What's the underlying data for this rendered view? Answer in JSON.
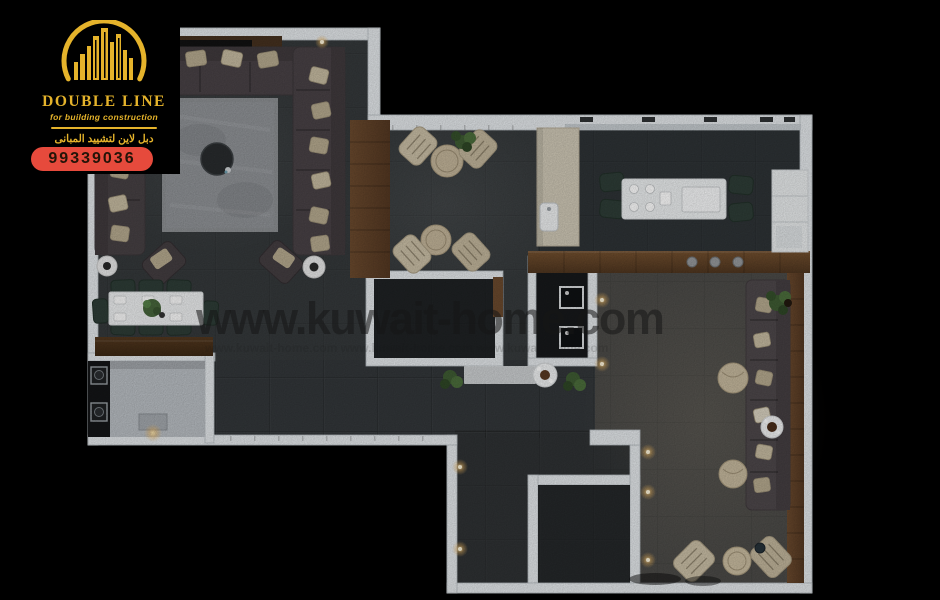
{
  "branding": {
    "company_name": "DOUBLE LINE",
    "tagline": "for building construction",
    "arabic_title": "دبل لاين لتشييد المبانى",
    "phone_number": "99339036",
    "colors": {
      "gold": "#e5b32b",
      "red": "#e64a3c",
      "digits": "#241408"
    }
  },
  "watermark": {
    "text": "www.kuwait-home.com",
    "tiled_text": "www.kuwait-home.com      www.kuwait-home.com      www.kuwait-home.com",
    "color": "#161616"
  },
  "scene": {
    "type": "3d-floor-plan-render",
    "colors": {
      "background": "#000000",
      "wall": "#e4e8eb",
      "floor_dark": "#35393b",
      "floor_kitchen": "#2e3336",
      "floor_majlis": "#4c4b48",
      "floor_utility": "#b9bec3",
      "room_core_dark": "#1f2224",
      "wood": "#5f4129",
      "rug": "#8d9093",
      "sofa": "#4b4549",
      "pillow": "#b6aa8f",
      "dining_chair_green": "#2e3d37",
      "lounge_chair_beige": "#cabfa6",
      "table_white": "#edeff0",
      "plant_green": "#44633a",
      "light_glow": "#ffd98a"
    }
  }
}
